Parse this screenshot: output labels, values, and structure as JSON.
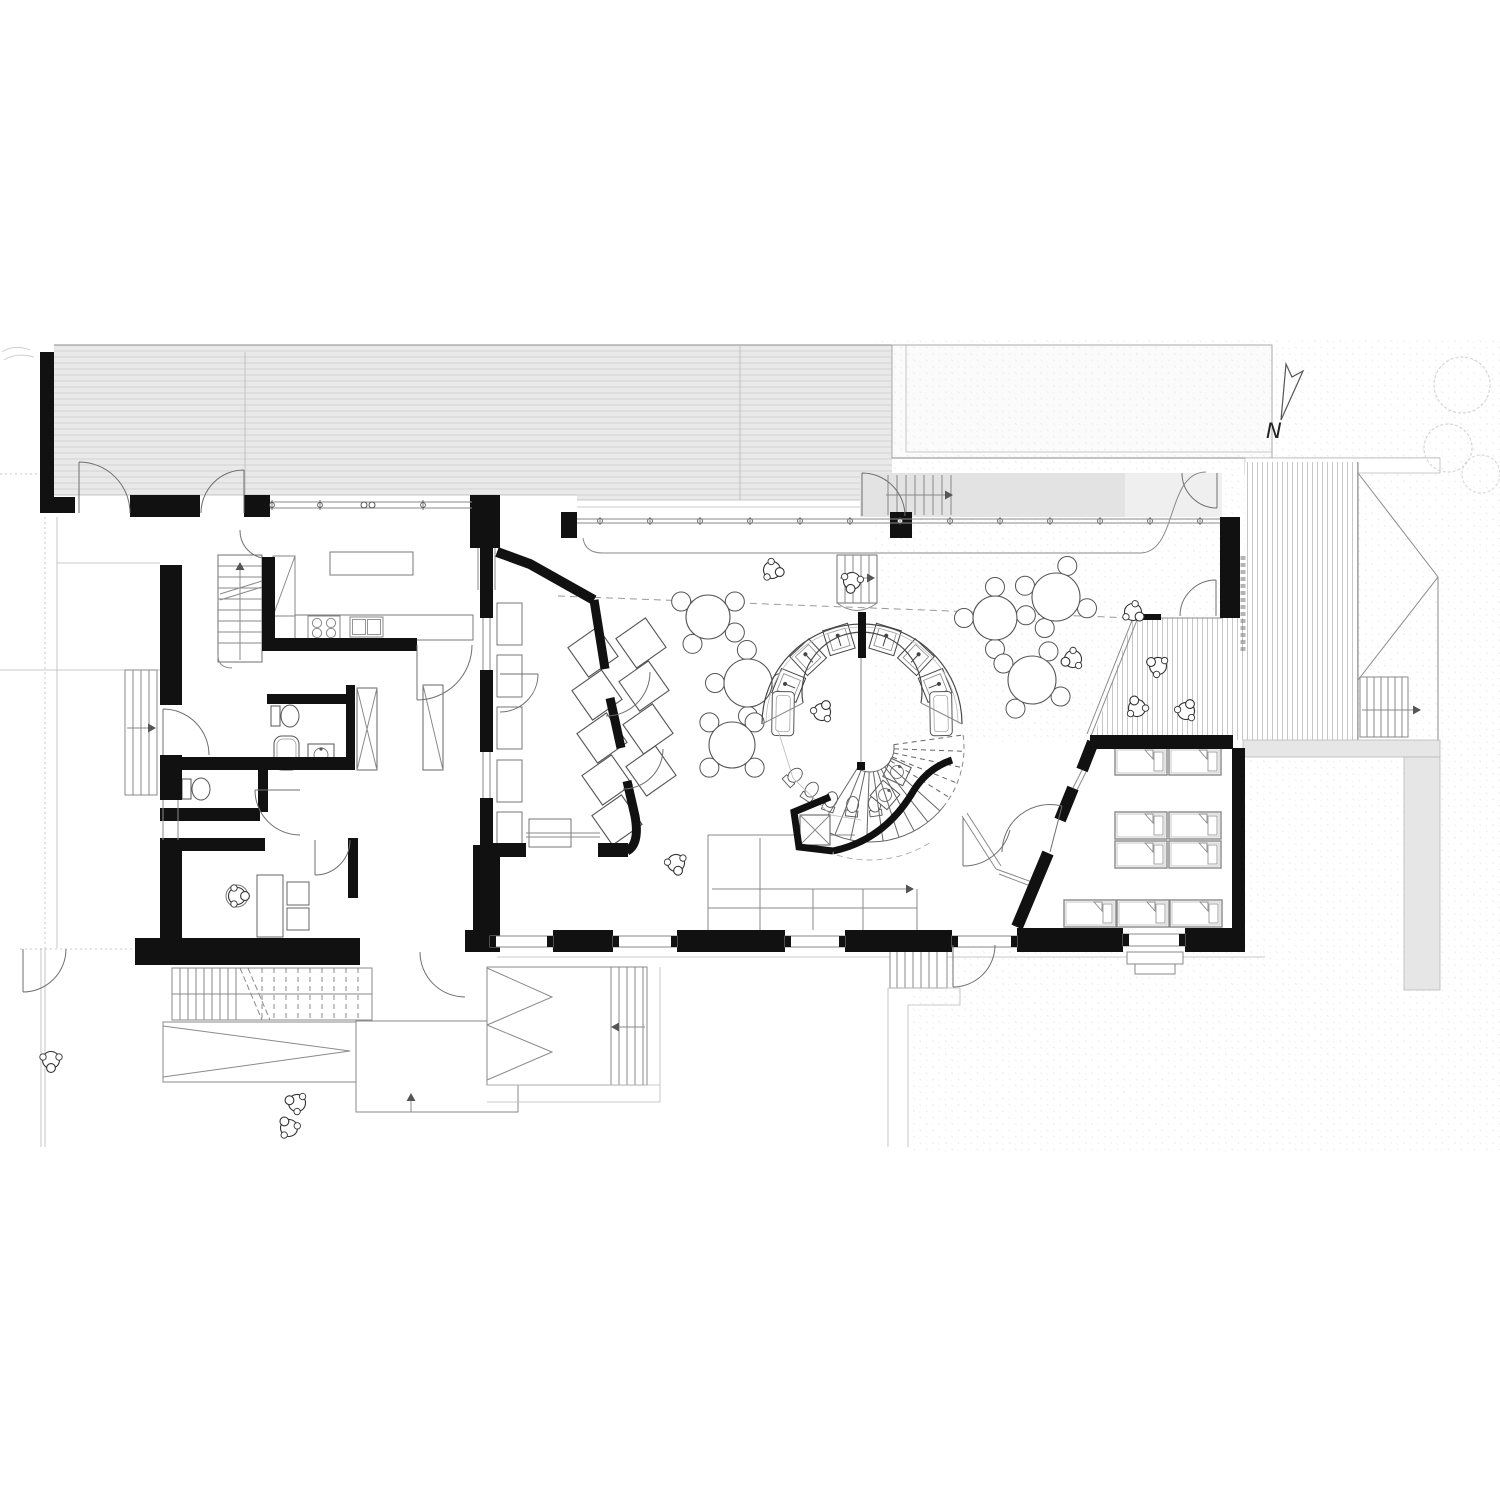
{
  "drawing": {
    "type": "architectural floor plan",
    "level": "ground floor of a kindergarten with central sanitary ring and spiral stair",
    "north_label": "N"
  },
  "colors": {
    "paper": "#ffffff",
    "wall": "#111111",
    "line": "#4a4a4a",
    "light_line": "#8a8a8a",
    "faint_line": "#b9b9b9",
    "terrace_fill": "#e9e9e9",
    "walkway_fill": "#e3e3e3",
    "walkway_fill_light": "#efefef",
    "platform_fill": "#e6e6e6",
    "neighbor_fill": "#fbfbfb",
    "hatch_line": "#d4d4d4",
    "deck_plank_line": "#b9b9b9"
  },
  "glass_wall_ticks": {
    "y": 517,
    "from": 600,
    "to": 1200,
    "step": 50
  },
  "north_window_ticks": {
    "y": 502,
    "xs": [
      272,
      320,
      423
    ],
    "double_x": 368
  },
  "hall_tables": [
    {
      "cx": 708,
      "cy": 617,
      "r": 22,
      "chairs": [
        210,
        330,
        30,
        120
      ]
    },
    {
      "cx": 748,
      "cy": 683,
      "r": 24,
      "chairs": [
        180,
        268,
        0,
        90
      ]
    },
    {
      "cx": 732,
      "cy": 745,
      "r": 23,
      "chairs": [
        225,
        315,
        45,
        135
      ]
    },
    {
      "cx": 1056,
      "cy": 597,
      "r": 24,
      "chairs": [
        200,
        290,
        20,
        110
      ]
    },
    {
      "cx": 995,
      "cy": 618,
      "r": 22,
      "chairs": [
        180,
        270,
        355,
        90
      ]
    },
    {
      "cx": 1032,
      "cy": 680,
      "r": 24,
      "chairs": [
        210,
        300,
        30,
        120
      ]
    }
  ],
  "group_room": {
    "table_size": 36,
    "table_rotation": -35,
    "tilted_tables": [
      {
        "cx": 593,
        "cy": 652
      },
      {
        "cx": 641,
        "cy": 643
      },
      {
        "cx": 597,
        "cy": 695
      },
      {
        "cx": 644,
        "cy": 686
      },
      {
        "cx": 602,
        "cy": 738
      },
      {
        "cx": 648,
        "cy": 729
      },
      {
        "cx": 607,
        "cy": 780
      },
      {
        "cx": 651,
        "cy": 771
      },
      {
        "cx": 617,
        "cy": 820
      }
    ],
    "benches": [
      {
        "x": 497,
        "y": 603
      },
      {
        "x": 497,
        "y": 655
      },
      {
        "x": 497,
        "y": 707
      },
      {
        "x": 497,
        "y": 760
      },
      {
        "x": 497,
        "y": 812
      }
    ],
    "bench_size": {
      "w": 25,
      "h": 42
    },
    "cabinet": {
      "x": 529,
      "y": 819,
      "w": 42,
      "h": 28
    }
  },
  "sleeping_room": {
    "cot_size": {
      "w": 52,
      "h": 27
    },
    "cots": [
      {
        "x": 1115,
        "y": 748
      },
      {
        "x": 1169,
        "y": 748
      },
      {
        "x": 1115,
        "y": 812
      },
      {
        "x": 1169,
        "y": 812
      },
      {
        "x": 1115,
        "y": 841
      },
      {
        "x": 1169,
        "y": 841
      },
      {
        "x": 1064,
        "y": 900
      },
      {
        "x": 1117,
        "y": 900
      },
      {
        "x": 1170,
        "y": 900
      }
    ]
  },
  "sanitary_ring": {
    "cx": 862,
    "cy": 715,
    "outer_r": 100,
    "outer_r2": 96,
    "inner_r": 60,
    "band_radius": 79,
    "changing_units_deg": [
      202,
      227,
      253,
      287,
      313,
      338
    ],
    "mats_deg": [
      181,
      359
    ],
    "toilets": {
      "radius": 92,
      "deg": [
        82,
        96,
        110,
        124,
        138
      ]
    },
    "basins": [
      {
        "x": 897,
        "y": 772,
        "rot": 25
      },
      {
        "x": 885,
        "y": 795,
        "rot": 40
      }
    ]
  },
  "spiral_stair": {
    "cx": 870,
    "cy": 748,
    "r_in": 24,
    "r_out": 94,
    "start_deg": -8,
    "end_deg": 122,
    "steps": 14,
    "dashed_below_deg": 38,
    "sweep_arc_r": 112
  },
  "people": [
    {
      "x": 772,
      "y": 570,
      "rot": 15
    },
    {
      "x": 852,
      "y": 581,
      "rot": 100
    },
    {
      "x": 1133,
      "y": 612,
      "rot": 35
    },
    {
      "x": 822,
      "y": 712,
      "rot": -60
    },
    {
      "x": 1073,
      "y": 659,
      "rot": 160
    },
    {
      "x": 676,
      "y": 863,
      "rot": 75
    },
    {
      "x": 1158,
      "y": 666,
      "rot": 210
    },
    {
      "x": 1137,
      "y": 708,
      "rot": 250
    },
    {
      "x": 1186,
      "y": 711,
      "rot": 300
    },
    {
      "x": 237,
      "y": 896,
      "rot": 0
    },
    {
      "x": 51,
      "y": 1060,
      "rot": 90
    },
    {
      "x": 297,
      "y": 1103,
      "rot": 200
    },
    {
      "x": 289,
      "y": 1128,
      "rot": 235
    }
  ]
}
